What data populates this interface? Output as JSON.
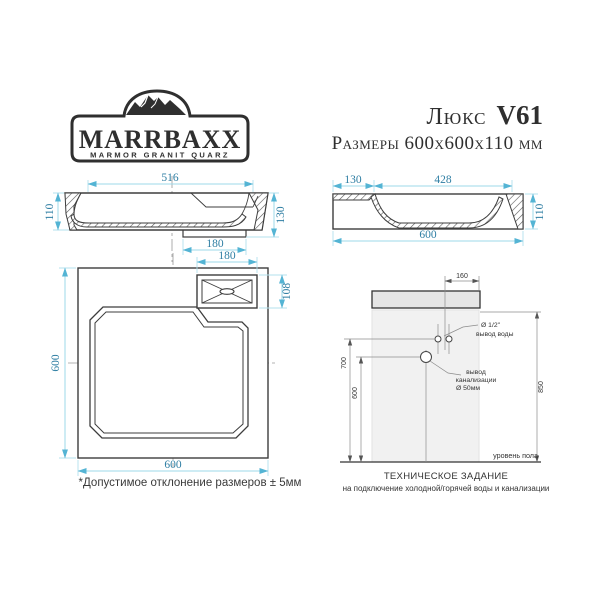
{
  "brand": {
    "name": "MARRBAXX",
    "tagline": "MARMOR GRANIT QUARZ"
  },
  "header": {
    "model_name": "Люкс",
    "model_code": "V61",
    "size_line": "Размеры 600х600х110 мм"
  },
  "section_side": {
    "top_width": "516",
    "height_left": "110",
    "height_right": "130",
    "drain_width": "180"
  },
  "section_front": {
    "ledge": "130",
    "basin": "428",
    "width": "600",
    "height": "110"
  },
  "top_view": {
    "height": "600",
    "width": "600",
    "box_width": "180",
    "box_height": "108"
  },
  "installation": {
    "offset_top": "160",
    "water_height": "700",
    "drain_height": "600",
    "total_height": "850",
    "water_label_1": "Ø 1/2\"",
    "water_label_2": "вывод воды",
    "drain_label_1": "вывод",
    "drain_label_2": "канализации",
    "drain_label_3": "Ø 50мм",
    "floor_label": "уровень пола"
  },
  "notes": {
    "tolerance": "*Допустимое отклонение размеров ± 5мм",
    "tech_title": "ТЕХНИЧЕСКОЕ ЗАДАНИЕ",
    "tech_subtitle": "на подключение холодной/горячей воды и канализации"
  },
  "colors": {
    "dimension_line": "#9ed8ea",
    "dimension_text": "#2e7ea3",
    "drawing_line": "#3d3d3d",
    "note_text": "#333333"
  }
}
